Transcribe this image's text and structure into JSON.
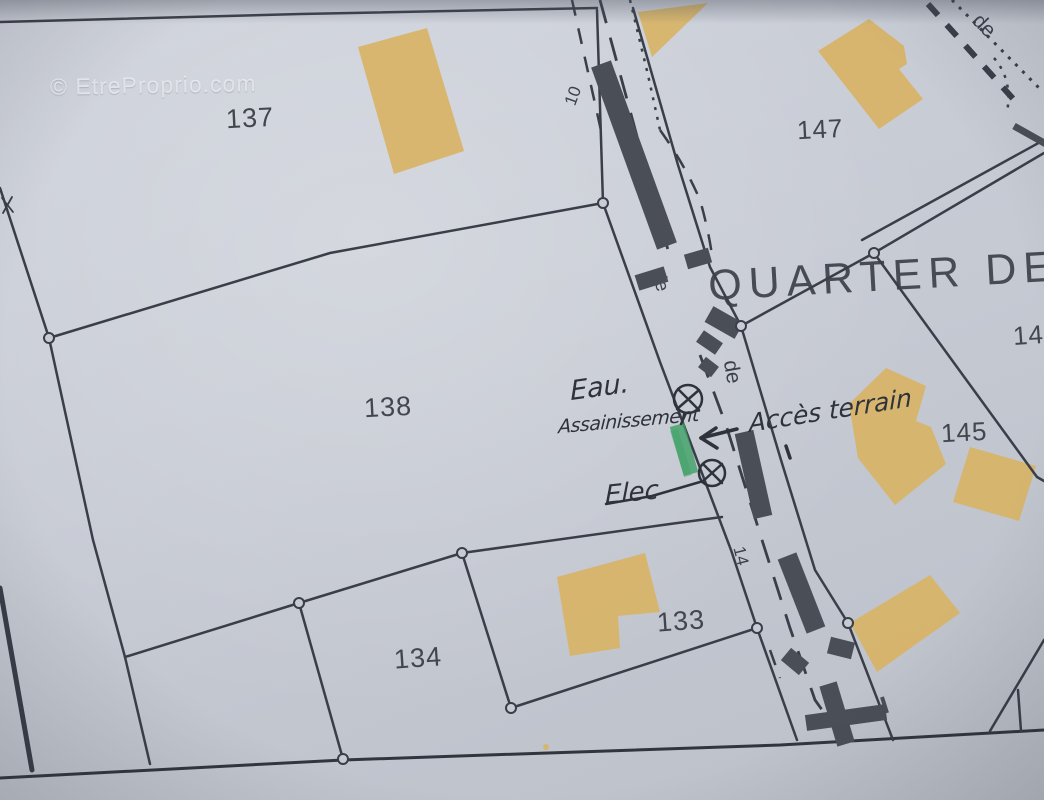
{
  "watermark": "© EtreProprio.com",
  "street": {
    "name": "QUARTER DE LA",
    "particle_mid": "de",
    "particle_lower": "de",
    "particle_corner": "de"
  },
  "parcels": {
    "p137": "137",
    "p147": "147",
    "p138": "138",
    "p145": "145",
    "p134": "134",
    "p133": "133",
    "p14_partial": "14"
  },
  "measurements": {
    "road_width_top": "10",
    "road_width_bottom": "14"
  },
  "annotations": {
    "water": "Eau.",
    "sewer": "Assainissement",
    "access": "Accès terrain",
    "electricity": "Elec"
  },
  "colors": {
    "paper": "#c7cbd4",
    "line": "#3a3e48",
    "roadfill": "#4a4e56",
    "building": "#d8b366",
    "ink": "#2e323b",
    "green": "#3da065",
    "label": "#42464f",
    "watermark": "rgba(240,243,248,0.72)"
  }
}
